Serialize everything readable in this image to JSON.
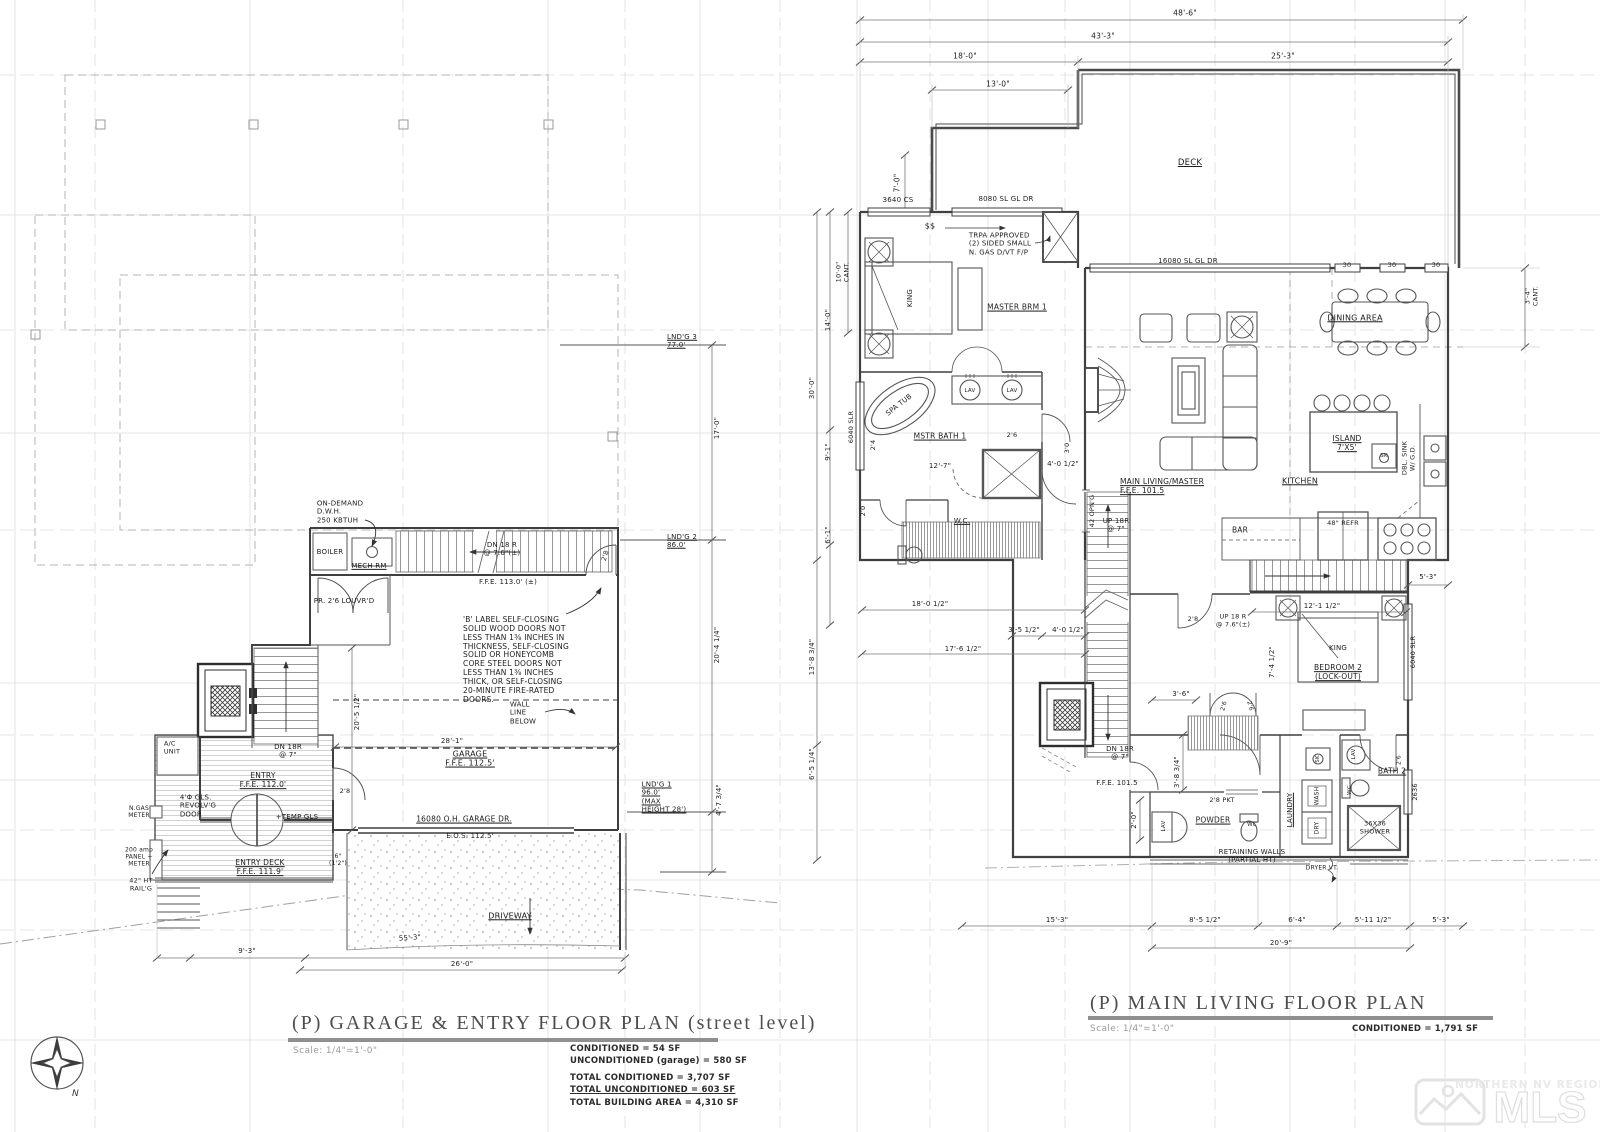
{
  "left_plan": {
    "title": "(P) GARAGE & ENTRY FLOOR PLAN (street level)",
    "scale_label": "Scale: 1/4\"=1'-0\"",
    "area_conditioned": "CONDITIONED = 54 SF",
    "area_unconditioned": "UNCONDITIONED (garage) = 580 SF",
    "total_conditioned": "TOTAL CONDITIONED = 3,707 SF",
    "total_unconditioned": "TOTAL UNCONDITIONED = 603 SF",
    "total_building": "TOTAL BUILDING AREA = 4,310 SF"
  },
  "right_plan": {
    "title": "(P) MAIN LIVING FLOOR PLAN",
    "scale_label": "Scale: 1/4\"=1'-0\"",
    "area_conditioned": "CONDITIONED = 1,791 SF"
  },
  "compass": {
    "north": "N"
  },
  "watermark": {
    "region": "NORTHERN NV REGIONAL",
    "brand": "MLS"
  },
  "colors": {
    "wall": "#3f3f3f",
    "grid": "#dcdcdc",
    "title_bar": "#8f8f8f",
    "watermark": "#e3e3e3"
  },
  "labels": [
    {
      "n": "note-dwh",
      "t": "ON-DEMAND\nD.W.H.\n250 KBTUH",
      "x": 340,
      "y": 512,
      "s": 7,
      "al": "left"
    },
    {
      "n": "label-boiler",
      "t": "BOILER",
      "x": 330,
      "y": 552,
      "s": 7
    },
    {
      "n": "label-mech-rm",
      "t": "MECH RM",
      "x": 369,
      "y": 566,
      "s": 7,
      "u": true
    },
    {
      "n": "label-dn18r-mech",
      "t": "DN 18 R\n@ 7.6\"(±)",
      "x": 502,
      "y": 549,
      "s": 7
    },
    {
      "n": "label-ffe-113",
      "t": "F.F.E. 113.0' (±)",
      "x": 508,
      "y": 582,
      "s": 7
    },
    {
      "n": "label-louvrd-doors",
      "t": "PR. 2'6 LOUVR'D",
      "x": 344,
      "y": 601,
      "s": 7
    },
    {
      "n": "label-door-28-mech",
      "t": "2'8",
      "x": 606,
      "y": 556,
      "s": 6.5,
      "r": -72
    },
    {
      "n": "note-b-label",
      "t": "'B' LABEL SELF-CLOSING\nSOLID WOOD DOORS NOT\nLESS THAN 1⅜ INCHES IN\nTHICKNESS, SELF-CLOSING\nSOLID OR HONEYCOMB\nCORE STEEL DOORS NOT\nLESS THAN 1⅜ INCHES\nTHICK, OR SELF-CLOSING\n20-MINUTE FIRE-RATED\nDOORS.",
      "x": 516,
      "y": 660,
      "s": 7.5,
      "al": "left"
    },
    {
      "n": "note-wall-line-below",
      "t": "WALL\nLINE\nBELOW",
      "x": 523,
      "y": 713,
      "s": 7,
      "al": "left"
    },
    {
      "n": "dim-20-5-1-2",
      "t": "20'-5 1/2\"",
      "x": 357,
      "y": 712,
      "s": 7,
      "r": -90
    },
    {
      "n": "dim-28-1",
      "t": "28'-1\"",
      "x": 452,
      "y": 741,
      "s": 7
    },
    {
      "n": "label-garage",
      "t": "GARAGE\nF.F.E. 112.5'",
      "x": 470,
      "y": 759,
      "s": 8,
      "u": true
    },
    {
      "n": "label-dn18r-entry",
      "t": "DN 18R\n@ 7\"",
      "x": 288,
      "y": 751,
      "s": 7
    },
    {
      "n": "label-entry",
      "t": "ENTRY\nF.F.E. 112.0'",
      "x": 263,
      "y": 781,
      "s": 7.5,
      "u": true
    },
    {
      "n": "label-door-28-entry",
      "t": "2'8",
      "x": 345,
      "y": 792,
      "s": 6.5
    },
    {
      "n": "label-ac-unit",
      "t": "A/C\nUNIT",
      "x": 172,
      "y": 748,
      "s": 6.5,
      "al": "left"
    },
    {
      "n": "label-ngas-meter",
      "t": "N.GAS\nMETER",
      "x": 139,
      "y": 812,
      "s": 6
    },
    {
      "n": "label-panel-meter",
      "t": "200 amp\nPANEL +\nMETER",
      "x": 139,
      "y": 857,
      "s": 6
    },
    {
      "n": "label-revolving-door",
      "t": "4'Φ GLS.\nREVOLV'G\nDOOR",
      "x": 198,
      "y": 806,
      "s": 7,
      "al": "left"
    },
    {
      "n": "label-temp-gls",
      "t": "+TEMP GLS",
      "x": 297,
      "y": 817,
      "s": 7
    },
    {
      "n": "label-entry-deck",
      "t": "ENTRY DECK\nF.F.E. 111.9'",
      "x": 260,
      "y": 868,
      "s": 7.5,
      "u": true
    },
    {
      "n": "label-railing",
      "t": "42\" HT\nRAIL'G",
      "x": 141,
      "y": 885,
      "s": 6.5
    },
    {
      "n": "label-garage-door",
      "t": "16080 O.H. GARAGE DR.",
      "x": 464,
      "y": 820,
      "s": 7.5,
      "u": true
    },
    {
      "n": "label-eos",
      "t": "E.O.S. 112.5'",
      "x": 470,
      "y": 836,
      "s": 7
    },
    {
      "n": "label-driveway",
      "t": "DRIVEWAY",
      "x": 510,
      "y": 916,
      "s": 8,
      "u": true
    },
    {
      "n": "dim-55-3",
      "t": "55'-3\"",
      "x": 410,
      "y": 938,
      "s": 7,
      "r": -4
    },
    {
      "n": "label-step",
      "t": "6\"\n(1'2\")",
      "x": 338,
      "y": 860,
      "s": 6
    },
    {
      "n": "dim-9-3",
      "t": "9'-3\"",
      "x": 247,
      "y": 951,
      "s": 7
    },
    {
      "n": "dim-26-0",
      "t": "26'-0\"",
      "x": 462,
      "y": 964,
      "s": 7
    },
    {
      "n": "label-landing-3",
      "t": "LND'G 3\n77.0'",
      "x": 682,
      "y": 341,
      "s": 7,
      "u": true,
      "al": "left"
    },
    {
      "n": "dim-17-0",
      "t": "17'-0\"",
      "x": 717,
      "y": 428,
      "s": 7,
      "r": -90
    },
    {
      "n": "label-landing-2",
      "t": "LND'G 2\n86.0'",
      "x": 682,
      "y": 541,
      "s": 7,
      "u": true,
      "al": "left"
    },
    {
      "n": "dim-20-4-1-4",
      "t": "20'-4 1/4\"",
      "x": 717,
      "y": 645,
      "s": 7,
      "r": -90
    },
    {
      "n": "label-landing-1",
      "t": "LND'G 1\n96.0'\n(MAX\nHEIGHT 28')",
      "x": 664,
      "y": 797,
      "s": 7,
      "u": true,
      "al": "left"
    },
    {
      "n": "dim-4-7-3-4",
      "t": "4'-7 3/4\"",
      "x": 719,
      "y": 800,
      "s": 7,
      "r": -90
    },
    {
      "n": "dim-48-6",
      "t": "48'-6\"",
      "x": 1185,
      "y": 14,
      "s": 7.5
    },
    {
      "n": "dim-43-3",
      "t": "43'-3\"",
      "x": 1103,
      "y": 37,
      "s": 7.5
    },
    {
      "n": "dim-18-0",
      "t": "18'-0\"",
      "x": 965,
      "y": 57,
      "s": 7.5
    },
    {
      "n": "dim-25-3",
      "t": "25'-3\"",
      "x": 1283,
      "y": 57,
      "s": 7.5
    },
    {
      "n": "dim-13-0",
      "t": "13'-0\"",
      "x": 998,
      "y": 85,
      "s": 7.5
    },
    {
      "n": "dim-7-0",
      "t": "7'-0\"",
      "x": 898,
      "y": 183,
      "s": 7.5,
      "r": -90
    },
    {
      "n": "label-deck",
      "t": "DECK",
      "x": 1190,
      "y": 163,
      "s": 8.5,
      "u": true
    },
    {
      "n": "label-win-3640cs",
      "t": "3640 CS",
      "x": 898,
      "y": 200,
      "s": 7
    },
    {
      "n": "label-sgd-8080",
      "t": "8080 SL GL DR",
      "x": 1006,
      "y": 199,
      "s": 7
    },
    {
      "n": "label-switch",
      "t": "$$",
      "x": 930,
      "y": 226,
      "s": 8
    },
    {
      "n": "note-trpa",
      "t": "TRPA APPROVED\n(2) SIDED SMALL\nN. GAS D/VT F/P",
      "x": 1000,
      "y": 244,
      "s": 7,
      "al": "left"
    },
    {
      "n": "label-king-1",
      "t": "KING",
      "x": 910,
      "y": 298,
      "s": 7,
      "r": -90
    },
    {
      "n": "label-master-brm",
      "t": "MASTER BRM 1",
      "x": 1017,
      "y": 308,
      "s": 7.5,
      "u": true
    },
    {
      "n": "label-sgd-16080",
      "t": "16080 SL GL DR",
      "x": 1188,
      "y": 261,
      "s": 7
    },
    {
      "n": "label-win-30-1",
      "t": "30",
      "x": 1347,
      "y": 266,
      "s": 6.5
    },
    {
      "n": "label-win-30-2",
      "t": "30",
      "x": 1392,
      "y": 266,
      "s": 6.5
    },
    {
      "n": "label-win-30-3",
      "t": "30",
      "x": 1436,
      "y": 266,
      "s": 6.5
    },
    {
      "n": "label-dining-area",
      "t": "DINING AREA",
      "x": 1355,
      "y": 318,
      "s": 8,
      "u": true
    },
    {
      "n": "dim-10-0-cant",
      "t": "10'-0\"\nCANT.",
      "x": 843,
      "y": 272,
      "s": 6.5,
      "r": -90
    },
    {
      "n": "dim-14-0",
      "t": "14'-0\"",
      "x": 828,
      "y": 320,
      "s": 7,
      "r": -90
    },
    {
      "n": "dim-30-0",
      "t": "30'-0\"",
      "x": 812,
      "y": 388,
      "s": 7,
      "r": -90
    },
    {
      "n": "dim-9-1",
      "t": "9'-1\"",
      "x": 828,
      "y": 452,
      "s": 7,
      "r": -90
    },
    {
      "n": "dim-6-1",
      "t": "6'-1\"",
      "x": 828,
      "y": 535,
      "s": 7,
      "r": -90
    },
    {
      "n": "label-win-6040-1",
      "t": "6040 SLR",
      "x": 852,
      "y": 427,
      "s": 6.5,
      "r": -90
    },
    {
      "n": "label-spa-tub",
      "t": "SPA TUB",
      "x": 899,
      "y": 405,
      "s": 7,
      "r": -38
    },
    {
      "n": "label-lav-1",
      "t": "LAV",
      "x": 970,
      "y": 391,
      "s": 5.5
    },
    {
      "n": "label-lav-2",
      "t": "LAV",
      "x": 1012,
      "y": 391,
      "s": 5.5
    },
    {
      "n": "label-mstr-bath",
      "t": "MSTR BATH 1",
      "x": 940,
      "y": 437,
      "s": 7.5,
      "u": true
    },
    {
      "n": "dim-12-7",
      "t": "12'-7\"",
      "x": 940,
      "y": 466,
      "s": 7
    },
    {
      "n": "dim-4-0-1-2-a",
      "t": "4'-0 1/2\"",
      "x": 1063,
      "y": 464,
      "s": 7
    },
    {
      "n": "label-door-26-a",
      "t": "2'6",
      "x": 1012,
      "y": 436,
      "s": 6.5
    },
    {
      "n": "label-door-30",
      "t": "3'0",
      "x": 1068,
      "y": 448,
      "s": 6.5,
      "r": -90
    },
    {
      "n": "label-wc-1",
      "t": "W.C.",
      "x": 962,
      "y": 521,
      "s": 7,
      "u": true
    },
    {
      "n": "label-door-24",
      "t": "2'4",
      "x": 874,
      "y": 445,
      "s": 6.5,
      "r": -90
    },
    {
      "n": "label-door-20",
      "t": "2'0",
      "x": 864,
      "y": 511,
      "s": 6.5,
      "r": -90
    },
    {
      "n": "label-opng-42",
      "t": "42 OPN'G",
      "x": 1093,
      "y": 511,
      "s": 6.5,
      "r": -90
    },
    {
      "n": "label-up18r-main",
      "t": "UP 18R\n@ 7\"",
      "x": 1116,
      "y": 525,
      "s": 7
    },
    {
      "n": "label-main-living",
      "t": "MAIN LIVING/MASTER\nF.F.E. 101.5",
      "x": 1162,
      "y": 487,
      "s": 7.5,
      "u": true,
      "al": "left"
    },
    {
      "n": "label-island",
      "t": "ISLAND\n7'X5'",
      "x": 1347,
      "y": 444,
      "s": 7.5,
      "u": true
    },
    {
      "n": "label-sink-island",
      "t": "SK",
      "x": 1384,
      "y": 456,
      "s": 5.5
    },
    {
      "n": "label-kitchen",
      "t": "KITCHEN",
      "x": 1300,
      "y": 481,
      "s": 8,
      "u": true
    },
    {
      "n": "label-dbl-sink",
      "t": "DBL. SINK\nW/ G.D.",
      "x": 1409,
      "y": 458,
      "s": 6.5,
      "r": -90
    },
    {
      "n": "label-bar",
      "t": "BAR",
      "x": 1240,
      "y": 531,
      "s": 7.5
    },
    {
      "n": "label-refr",
      "t": "48\" REFR",
      "x": 1343,
      "y": 524,
      "s": 6.5
    },
    {
      "n": "dim-3-4-cant",
      "t": "3'-4\"\nCANT.",
      "x": 1532,
      "y": 296,
      "s": 6.5,
      "r": -90
    },
    {
      "n": "dim-5-3-a",
      "t": "5'-3\"",
      "x": 1428,
      "y": 577,
      "s": 7
    },
    {
      "n": "label-up18r-bed",
      "t": "UP 18 R\n@ 7.6\"(±)",
      "x": 1233,
      "y": 621,
      "s": 6.5
    },
    {
      "n": "label-door-28-b",
      "t": "2'8",
      "x": 1193,
      "y": 620,
      "s": 6.5
    },
    {
      "n": "dim-12-1-1-2",
      "t": "12'-1 1/2\"",
      "x": 1322,
      "y": 606,
      "s": 7
    },
    {
      "n": "label-king-2",
      "t": "KING",
      "x": 1338,
      "y": 648,
      "s": 7
    },
    {
      "n": "label-bedroom-2",
      "t": "BEDROOM 2\n(LOCK-OUT)",
      "x": 1338,
      "y": 673,
      "s": 7.5,
      "u": true
    },
    {
      "n": "dim-7-4-1-2",
      "t": "7'-4 1/2\"",
      "x": 1272,
      "y": 662,
      "s": 7,
      "r": -90
    },
    {
      "n": "label-win-6040-2",
      "t": "6040 SLR",
      "x": 1414,
      "y": 652,
      "s": 6.5,
      "r": -90
    },
    {
      "n": "dim-3-6",
      "t": "3'-6\"",
      "x": 1181,
      "y": 694,
      "s": 7
    },
    {
      "n": "label-door-26-b",
      "t": "2'6",
      "x": 1224,
      "y": 706,
      "s": 6,
      "r": -75
    },
    {
      "n": "label-door-26-c",
      "t": "2'6",
      "x": 1250,
      "y": 706,
      "s": 6,
      "r": 75
    },
    {
      "n": "dim-18-0-1-2",
      "t": "18'-0 1/2\"",
      "x": 930,
      "y": 604,
      "s": 7
    },
    {
      "n": "dim-3-5-1-2",
      "t": "3'-5 1/2\"",
      "x": 1024,
      "y": 630,
      "s": 7
    },
    {
      "n": "dim-4-0-1-2-b",
      "t": "4'-0 1/2\"",
      "x": 1068,
      "y": 630,
      "s": 7
    },
    {
      "n": "dim-17-6-1-2",
      "t": "17'-6 1/2\"",
      "x": 963,
      "y": 649,
      "s": 7
    },
    {
      "n": "dim-13-8-3-4",
      "t": "13'-8 3/4\"",
      "x": 812,
      "y": 657,
      "s": 7,
      "r": -90
    },
    {
      "n": "dim-6-5-1-4",
      "t": "6'-5 1/4\"",
      "x": 812,
      "y": 764,
      "s": 7,
      "r": -90
    },
    {
      "n": "label-ffe-1015",
      "t": "F.F.E. 101.5",
      "x": 1117,
      "y": 783,
      "s": 7
    },
    {
      "n": "label-dn18r-main",
      "t": "DN 18R\n@ 7\"",
      "x": 1120,
      "y": 753,
      "s": 7
    },
    {
      "n": "dim-3-8-3-4",
      "t": "3'-8 3/4\"",
      "x": 1177,
      "y": 772,
      "s": 7,
      "r": -90
    },
    {
      "n": "label-pkt-door",
      "t": "2'8 PKT",
      "x": 1222,
      "y": 801,
      "s": 6.5
    },
    {
      "n": "label-powder",
      "t": "POWDER",
      "x": 1213,
      "y": 821,
      "s": 7.5,
      "u": true
    },
    {
      "n": "label-lav-3",
      "t": "LAV",
      "x": 1164,
      "y": 826,
      "s": 5.5,
      "r": -90
    },
    {
      "n": "label-wc-2",
      "t": "WC",
      "x": 1252,
      "y": 825,
      "s": 5.5
    },
    {
      "n": "label-laundry",
      "t": "LAUNDRY",
      "x": 1290,
      "y": 810,
      "s": 7,
      "r": -90,
      "u": true
    },
    {
      "n": "label-wash",
      "t": "WASH",
      "x": 1317,
      "y": 796,
      "s": 6,
      "r": -90
    },
    {
      "n": "label-dry",
      "t": "DRY",
      "x": 1317,
      "y": 828,
      "s": 6,
      "r": -90
    },
    {
      "n": "label-sink-laundry",
      "t": "SK",
      "x": 1318,
      "y": 759,
      "s": 5.5,
      "r": -90
    },
    {
      "n": "label-bath-2",
      "t": "BATH 2",
      "x": 1392,
      "y": 772,
      "s": 7.5,
      "u": true
    },
    {
      "n": "label-lav-4",
      "t": "LAV",
      "x": 1354,
      "y": 754,
      "s": 5.5,
      "r": -90
    },
    {
      "n": "label-wc-3",
      "t": "WC",
      "x": 1350,
      "y": 790,
      "s": 5.5,
      "r": -90
    },
    {
      "n": "label-shower",
      "t": "36X36\nSHOWER",
      "x": 1375,
      "y": 828,
      "s": 6.5
    },
    {
      "n": "label-win-2636",
      "t": "2636",
      "x": 1416,
      "y": 792,
      "s": 6.5,
      "r": -90
    },
    {
      "n": "label-door-26-d",
      "t": "2'6",
      "x": 1399,
      "y": 760,
      "s": 6,
      "r": -90
    },
    {
      "n": "dim-2-0",
      "t": "2'-0\"",
      "x": 1134,
      "y": 820,
      "s": 7,
      "r": -90
    },
    {
      "n": "note-retaining",
      "t": "RETAINING WALLS\n(PARTIAL HT)",
      "x": 1252,
      "y": 856,
      "s": 7
    },
    {
      "n": "label-dryer-vent",
      "t": "DRYER VT.",
      "x": 1322,
      "y": 868,
      "s": 6
    },
    {
      "n": "dim-8-5-1-2",
      "t": "8'-5 1/2\"",
      "x": 1205,
      "y": 920,
      "s": 7
    },
    {
      "n": "dim-6-4",
      "t": "6'-4\"",
      "x": 1297,
      "y": 920,
      "s": 7
    },
    {
      "n": "dim-5-11-1-2",
      "t": "5'-11 1/2\"",
      "x": 1373,
      "y": 920,
      "s": 7
    },
    {
      "n": "dim-20-9",
      "t": "20'-9\"",
      "x": 1281,
      "y": 943,
      "s": 7
    },
    {
      "n": "dim-15-3",
      "t": "15'-3\"",
      "x": 1057,
      "y": 920,
      "s": 7
    },
    {
      "n": "dim-5-3-b",
      "t": "5'-3\"",
      "x": 1441,
      "y": 920,
      "s": 7
    }
  ]
}
